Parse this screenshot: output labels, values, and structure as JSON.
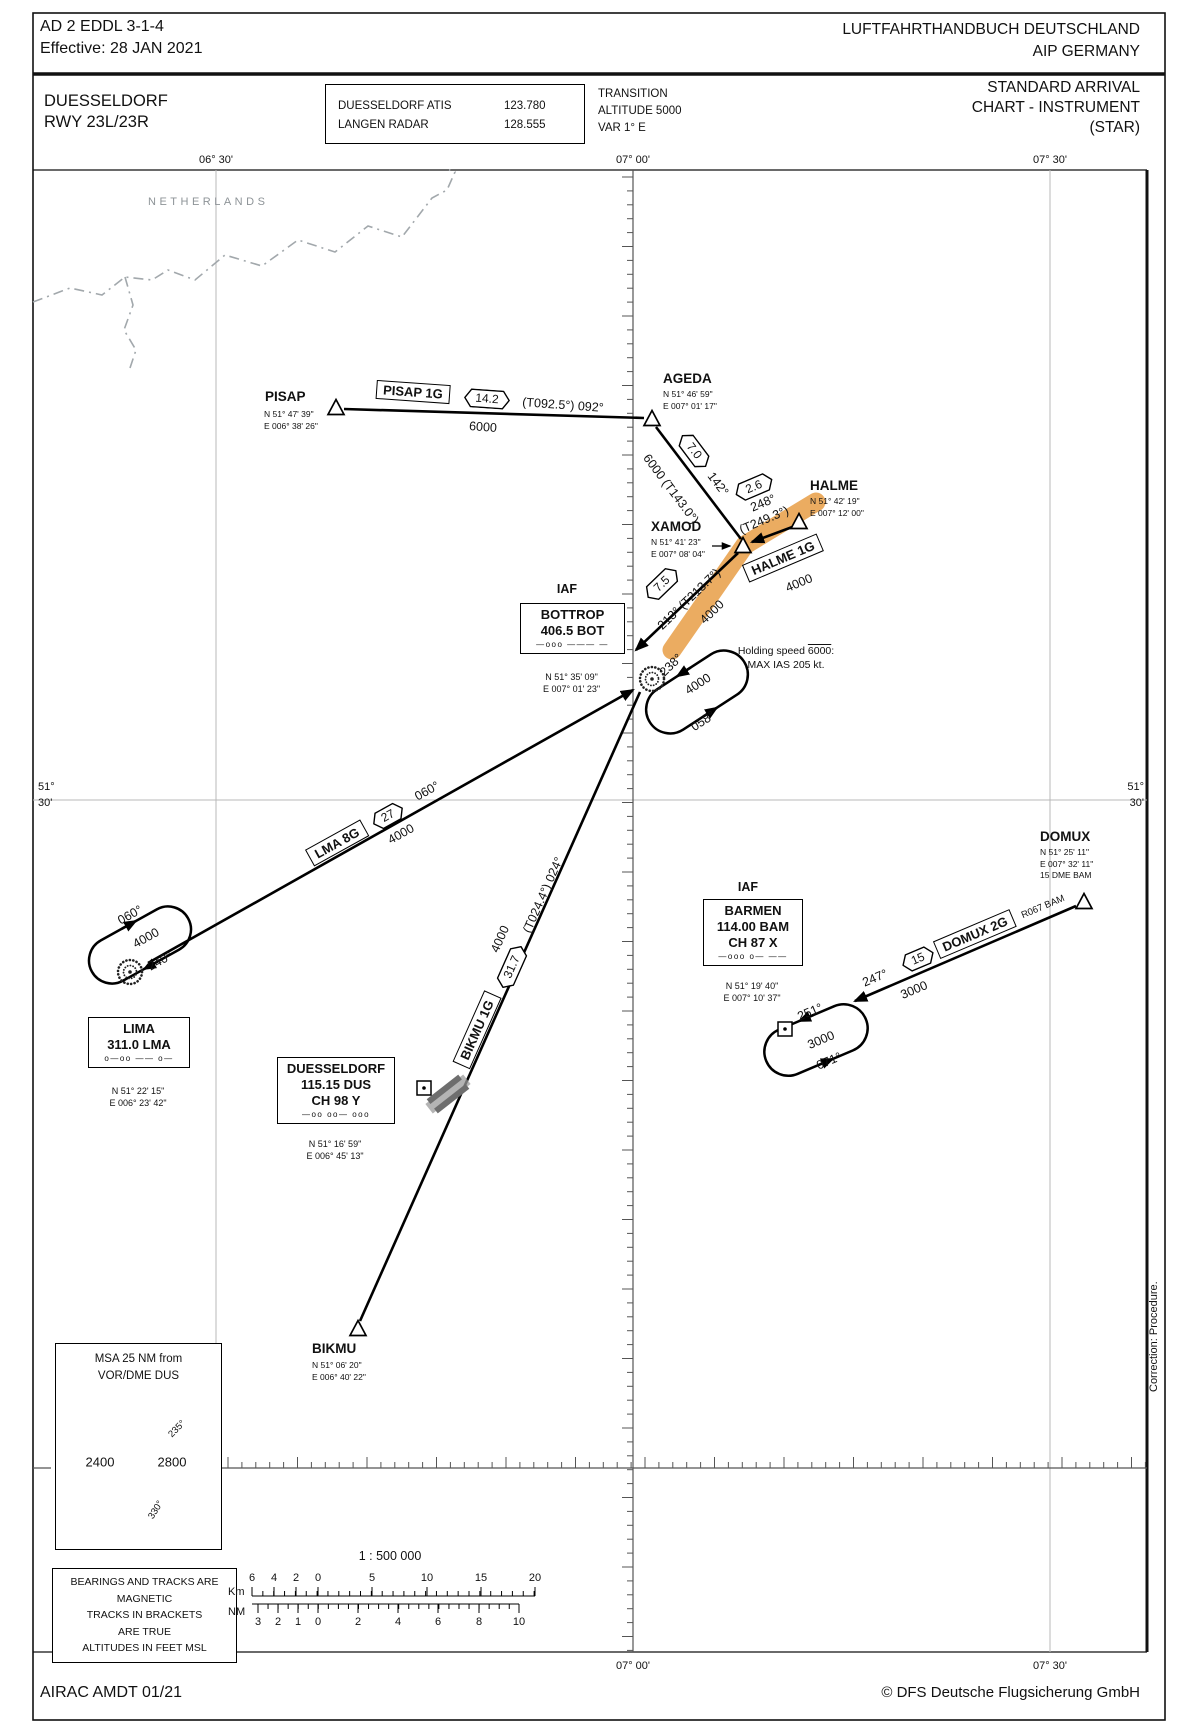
{
  "header": {
    "doc_ref": "AD 2 EDDL 3-1-4",
    "effective": "Effective: 28 JAN 2021",
    "handbook": "LUFTFAHRTHANDBUCH DEUTSCHLAND",
    "aip": "AIP  GERMANY"
  },
  "title_block": {
    "airport": "DUESSELDORF",
    "runway": "RWY 23L/23R",
    "atis_label": "DUESSELDORF ATIS",
    "atis_freq": "123.780",
    "radar_label": "LANGEN RADAR",
    "radar_freq": "128.555",
    "transition1": "TRANSITION",
    "transition2": "ALTITUDE 5000",
    "transition3": "VAR 1° E",
    "chart1": "STANDARD ARRIVAL",
    "chart2": "CHART - INSTRUMENT",
    "chart3": "(STAR)"
  },
  "grid": {
    "top": [
      "06° 30'",
      "07° 00'",
      "07° 30'"
    ],
    "bottom": [
      "07° 00'",
      "07° 30'"
    ],
    "lat_deg": "51°",
    "lat_min": "30'"
  },
  "region": "NETHERLANDS",
  "waypoints": [
    {
      "id": "pisap",
      "name": "PISAP",
      "c1": "N 51° 47' 39\"",
      "c2": "E 006° 38' 26\"",
      "c3": ""
    },
    {
      "id": "ageda",
      "name": "AGEDA",
      "c1": "N 51° 46' 59\"",
      "c2": "E 007° 01' 17\"",
      "c3": ""
    },
    {
      "id": "xamod",
      "name": "XAMOD",
      "c1": "N 51° 41' 23\"",
      "c2": "E 007° 08' 04\"",
      "c3": ""
    },
    {
      "id": "halme",
      "name": "HALME",
      "c1": "N 51° 42' 19\"",
      "c2": "E 007° 12' 00\"",
      "c3": ""
    },
    {
      "id": "bikmu",
      "name": "BIKMU",
      "c1": "N 51° 06' 20\"",
      "c2": "E 006° 40' 22\"",
      "c3": ""
    },
    {
      "id": "domux",
      "name": "DOMUX",
      "c1": "N 51° 25' 11\"",
      "c2": "E 007° 32' 11\"",
      "c3": "15 DME  BAM"
    }
  ],
  "navaids": [
    {
      "id": "bottrop",
      "iaf": "IAF",
      "l1": "BOTTROP",
      "l2": "406.5 BOT",
      "l3": "",
      "morse": "—ooo ——— —",
      "c1": "N 51° 35' 09\"",
      "c2": "E 007° 01' 23\""
    },
    {
      "id": "lima",
      "iaf": "",
      "l1": "LIMA",
      "l2": "311.0 LMA",
      "l3": "",
      "morse": "o—oo —— o—",
      "c1": "N 51° 22' 15\"",
      "c2": "E 006° 23' 42\""
    },
    {
      "id": "dus",
      "iaf": "",
      "l1": "DUESSELDORF",
      "l2": "115.15 DUS",
      "l3": "CH 98 Y",
      "morse": "—oo oo— ooo",
      "c1": "N 51° 16' 59\"",
      "c2": "E 006° 45' 13\""
    },
    {
      "id": "barmen",
      "iaf": "IAF",
      "l1": "BARMEN",
      "l2": "114.00 BAM",
      "l3": "CH 87 X",
      "morse": "—ooo o— ——",
      "c1": "N 51° 19' 40\"",
      "c2": "E 007° 10' 37\""
    }
  ],
  "labels": {
    "pisap1g": "PISAP 1G",
    "d142": "14.2",
    "t0925": "(T092.5°) 092°",
    "a6000p": "6000",
    "d70": "7.0",
    "t1430": "6000 (T143.0°)",
    "c142": "142°",
    "d26": "2.6",
    "c248": "248°",
    "t2493": "(T249.3°)",
    "halme1g": "HALME 1G",
    "a4000h": "4000",
    "d75": "7.5",
    "t2137": "213° (T213.7°)",
    "a4000x": "4000",
    "c238": "238°",
    "a4000bh": "4000",
    "c058": "058°",
    "lma8g": "LMA 8G",
    "d27": "27",
    "c060r": "060°",
    "a4000l": "4000",
    "c060h": "060°",
    "a4000lh": "4000",
    "c240": "240°",
    "bikmu1g": "BIKMU 1G",
    "d317": "31.7",
    "a4000b": "4000",
    "t0244": "(T024.4°) 024°",
    "r067": "R067 BAM",
    "domux2g": "DOMUX 2G",
    "d15": "15",
    "c247": "247°",
    "a3000d": "3000",
    "c251": "251°",
    "a3000bh": "3000",
    "c071": "071°",
    "m235": "235°",
    "m330": "330°"
  },
  "holding_note": {
    "l1a": "Holding speed ",
    "l1b": "6000",
    "l1c": ":",
    "l2": "MAX IAS 205 kt."
  },
  "msa": {
    "title1": "MSA 25 NM from",
    "title2": "VOR/DME DUS",
    "left": "2400",
    "right": "2800"
  },
  "bearing_note": [
    "BEARINGS AND TRACKS ARE",
    "MAGNETIC",
    "TRACKS IN BRACKETS",
    "ARE TRUE",
    "ALTITUDES IN FEET MSL"
  ],
  "scale": {
    "ratio": "1 : 500 000",
    "km_label": "Km",
    "nm_label": "NM",
    "km_numbers": [
      "6",
      "4",
      "2",
      "0",
      "5",
      "10",
      "15",
      "20"
    ],
    "nm_numbers": [
      "3",
      "2",
      "1",
      "0",
      "2",
      "4",
      "6",
      "8",
      "10"
    ]
  },
  "footer": {
    "airac": "AIRAC AMDT 01/21",
    "copyright": "© DFS Deutsche Flugsicherung GmbH"
  },
  "correction": "Correction: Procedure."
}
